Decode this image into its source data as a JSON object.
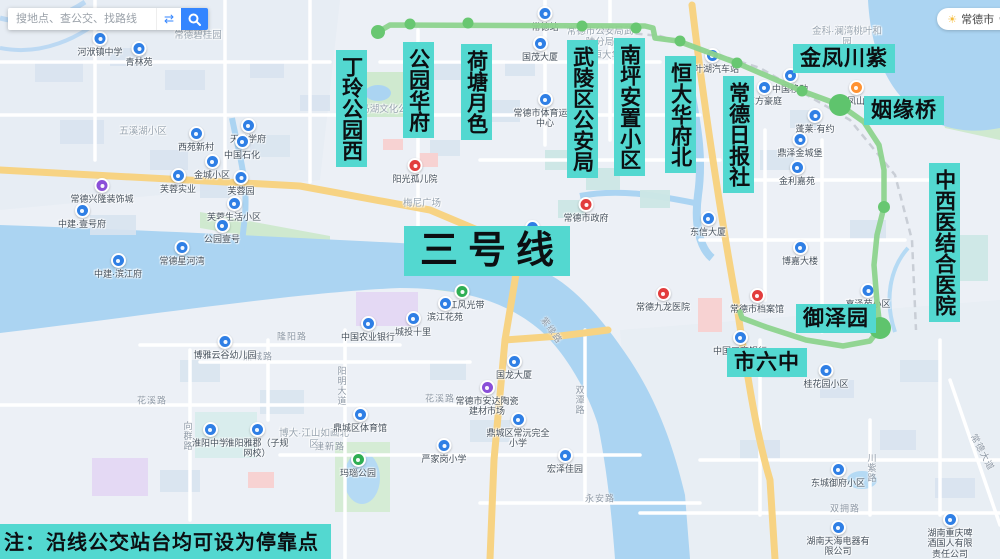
{
  "colors": {
    "label_bg": "#53d8d0",
    "route_line": "#8dd38d",
    "route_stop": "#68c771",
    "water": "#abd4f2",
    "accent_blue": "#3385ff"
  },
  "search": {
    "placeholder": "搜地点、查公交、找路线"
  },
  "city": {
    "name": "常德市",
    "caret": "∨",
    "weather_icon": "sun-icon"
  },
  "route": {
    "title": "三号线",
    "title_pos": {
      "x": 404,
      "y": 226
    },
    "note": "注：沿线公交站台均可设为停靠点",
    "polyline": [
      [
        378,
        32
      ],
      [
        390,
        25
      ],
      [
        645,
        26
      ],
      [
        653,
        28
      ],
      [
        655,
        38
      ],
      [
        678,
        41
      ],
      [
        737,
        63
      ],
      [
        802,
        91
      ],
      [
        840,
        105
      ],
      [
        864,
        122
      ],
      [
        879,
        145
      ],
      [
        884,
        170
      ],
      [
        884,
        207
      ],
      [
        877,
        235
      ],
      [
        874,
        265
      ],
      [
        877,
        302
      ],
      [
        880,
        328
      ],
      [
        870,
        341
      ],
      [
        843,
        346
      ],
      [
        806,
        340
      ],
      [
        766,
        327
      ],
      [
        742,
        318
      ],
      [
        740,
        312
      ]
    ],
    "stops": [
      {
        "x": 378,
        "y": 32,
        "r": 7
      },
      {
        "x": 410,
        "y": 24,
        "r": 5.5
      },
      {
        "x": 468,
        "y": 23,
        "r": 5.5
      },
      {
        "x": 582,
        "y": 26,
        "r": 5.5
      },
      {
        "x": 636,
        "y": 28,
        "r": 5.5
      },
      {
        "x": 680,
        "y": 41,
        "r": 5.5
      },
      {
        "x": 737,
        "y": 63,
        "r": 5.5
      },
      {
        "x": 802,
        "y": 91,
        "r": 5.5
      },
      {
        "x": 884,
        "y": 207,
        "r": 6
      },
      {
        "x": 840,
        "y": 105,
        "r": 11
      },
      {
        "x": 880,
        "y": 328,
        "r": 11
      }
    ],
    "stations": [
      {
        "text": "丁玲公园西",
        "x": 336,
        "y": 50,
        "v": true
      },
      {
        "text": "公园华府",
        "x": 403,
        "y": 42,
        "v": true
      },
      {
        "text": "荷塘月色",
        "x": 461,
        "y": 44,
        "v": true
      },
      {
        "text": "武陵区公安局",
        "x": 567,
        "y": 40,
        "v": true
      },
      {
        "text": "南坪安置小区",
        "x": 614,
        "y": 38,
        "v": true
      },
      {
        "text": "恒大华府北",
        "x": 665,
        "y": 56,
        "v": true
      },
      {
        "text": "常德日报社",
        "x": 723,
        "y": 76,
        "v": true
      },
      {
        "text": "金凤川紫",
        "x": 793,
        "y": 44,
        "v": false
      },
      {
        "text": "姻缘桥",
        "x": 864,
        "y": 96,
        "v": false
      },
      {
        "text": "中西医结合医院",
        "x": 929,
        "y": 163,
        "v": true
      },
      {
        "text": "御泽园",
        "x": 796,
        "y": 304,
        "v": false
      },
      {
        "text": "市六中",
        "x": 727,
        "y": 348,
        "v": false
      }
    ]
  },
  "map": {
    "pois": [
      {
        "t": "河洑镇中学",
        "x": 100,
        "y": 31,
        "c": "blue"
      },
      {
        "t": "青林苑",
        "x": 139,
        "y": 41,
        "c": "blue"
      },
      {
        "t": "常德碧桂园",
        "x": 198,
        "y": 30,
        "c": "area"
      },
      {
        "t": "五溪湖小区",
        "x": 143,
        "y": 126,
        "c": "area"
      },
      {
        "t": "西苑新村",
        "x": 196,
        "y": 126,
        "c": "blue"
      },
      {
        "t": "天健学府",
        "x": 248,
        "y": 118,
        "c": "blue"
      },
      {
        "t": "中国石化",
        "x": 242,
        "y": 134,
        "c": "blue"
      },
      {
        "t": "金城小区",
        "x": 212,
        "y": 154,
        "c": "blue"
      },
      {
        "t": "芙蓉实业",
        "x": 178,
        "y": 168,
        "c": "blue"
      },
      {
        "t": "芙蓉园",
        "x": 241,
        "y": 170,
        "c": "blue"
      },
      {
        "t": "常德兴隆装饰城",
        "x": 102,
        "y": 178,
        "c": "purple"
      },
      {
        "t": "中建·壹号府",
        "x": 82,
        "y": 203,
        "c": "blue"
      },
      {
        "t": "芙蓉生活小区",
        "x": 234,
        "y": 196,
        "c": "blue"
      },
      {
        "t": "公园壹号",
        "x": 222,
        "y": 218,
        "c": "blue"
      },
      {
        "t": "常德星河湾",
        "x": 182,
        "y": 240,
        "c": "blue"
      },
      {
        "t": "中建·滨江府",
        "x": 118,
        "y": 253,
        "c": "blue"
      },
      {
        "t": "白马湖文化公园",
        "x": 384,
        "y": 104,
        "c": "area"
      },
      {
        "t": "阳光孤儿院",
        "x": 415,
        "y": 158,
        "c": "red"
      },
      {
        "t": "梅尼广场",
        "x": 422,
        "y": 198,
        "c": "area"
      },
      {
        "t": "中国农业银行",
        "x": 368,
        "y": 316,
        "c": "blue"
      },
      {
        "t": "时代大厦",
        "x": 532,
        "y": 220,
        "c": "blue"
      },
      {
        "t": "常德站",
        "x": 545,
        "y": 6,
        "c": "blue"
      },
      {
        "t": "国茂大厦",
        "x": 540,
        "y": 36,
        "c": "blue"
      },
      {
        "t": "常德市公安局武陵分局",
        "x": 600,
        "y": 26,
        "c": "area"
      },
      {
        "t": "常德恒大华府",
        "x": 602,
        "y": 50,
        "c": "area"
      },
      {
        "t": "常德市体育运动中心",
        "x": 545,
        "y": 92,
        "c": "blue"
      },
      {
        "t": "常德市政府",
        "x": 586,
        "y": 197,
        "c": "red"
      },
      {
        "t": "桃叶湖汽车站",
        "x": 712,
        "y": 48,
        "c": "blue"
      },
      {
        "t": "金科·澜湾桃叶和园",
        "x": 847,
        "y": 26,
        "c": "area"
      },
      {
        "t": "中国移动",
        "x": 790,
        "y": 68,
        "c": "blue"
      },
      {
        "t": "东方豪庭",
        "x": 764,
        "y": 80,
        "c": "blue"
      },
      {
        "t": "龙凤山庄",
        "x": 856,
        "y": 80,
        "c": "orange"
      },
      {
        "t": "蓬莱·有约",
        "x": 815,
        "y": 108,
        "c": "blue"
      },
      {
        "t": "鼎泽金城堡",
        "x": 800,
        "y": 132,
        "c": "blue"
      },
      {
        "t": "金利嘉苑",
        "x": 797,
        "y": 160,
        "c": "blue"
      },
      {
        "t": "东信大厦",
        "x": 708,
        "y": 211,
        "c": "blue"
      },
      {
        "t": "博嘉大楼",
        "x": 800,
        "y": 240,
        "c": "blue"
      },
      {
        "t": "嘉泽苑小区",
        "x": 868,
        "y": 283,
        "c": "blue"
      },
      {
        "t": "常德九龙医院",
        "x": 663,
        "y": 286,
        "c": "red"
      },
      {
        "t": "常德市档案馆",
        "x": 757,
        "y": 288,
        "c": "red"
      },
      {
        "t": "中国工商银行",
        "x": 740,
        "y": 330,
        "c": "blue"
      },
      {
        "t": "桂花园小区",
        "x": 826,
        "y": 363,
        "c": "blue"
      },
      {
        "t": "沅江风光带",
        "x": 462,
        "y": 284,
        "c": "green"
      },
      {
        "t": "滨江花苑",
        "x": 445,
        "y": 296,
        "c": "blue"
      },
      {
        "t": "城投十里",
        "x": 413,
        "y": 311,
        "c": "blue"
      },
      {
        "t": "博雅云谷幼儿园",
        "x": 225,
        "y": 334,
        "c": "blue"
      },
      {
        "t": "淮阳中学",
        "x": 210,
        "y": 422,
        "c": "blue"
      },
      {
        "t": "淮阳雅郡（子规网校）",
        "x": 257,
        "y": 422,
        "c": "blue"
      },
      {
        "t": "博大·江山如画北区",
        "x": 314,
        "y": 428,
        "c": "area"
      },
      {
        "t": "鼎城区体育馆",
        "x": 360,
        "y": 407,
        "c": "blue"
      },
      {
        "t": "玛瑙公园",
        "x": 358,
        "y": 452,
        "c": "green"
      },
      {
        "t": "国龙大厦",
        "x": 514,
        "y": 354,
        "c": "blue"
      },
      {
        "t": "常德市安达陶瓷建材市场",
        "x": 487,
        "y": 380,
        "c": "purple"
      },
      {
        "t": "鼎城区常沅完全小学",
        "x": 518,
        "y": 412,
        "c": "blue"
      },
      {
        "t": "严家岗小学",
        "x": 444,
        "y": 438,
        "c": "blue"
      },
      {
        "t": "宏泽佳园",
        "x": 565,
        "y": 448,
        "c": "blue"
      },
      {
        "t": "东城御府小区",
        "x": 838,
        "y": 462,
        "c": "blue"
      },
      {
        "t": "湖南天海电器有限公司",
        "x": 838,
        "y": 520,
        "c": "blue"
      },
      {
        "t": "湖南重庆啤酒国人有限责任公司",
        "x": 950,
        "y": 512,
        "c": "blue"
      }
    ],
    "road_labels": [
      {
        "t": "双拥路",
        "x": 845,
        "y": 508
      },
      {
        "t": "常德大道",
        "x": 983,
        "y": 452,
        "r": 62
      },
      {
        "t": "川紫路",
        "x": 872,
        "y": 468,
        "v": true
      },
      {
        "t": "花溪路",
        "x": 152,
        "y": 400
      },
      {
        "t": "花溪路",
        "x": 440,
        "y": 398
      },
      {
        "t": "向群路",
        "x": 188,
        "y": 436,
        "v": true
      },
      {
        "t": "隆阳路",
        "x": 292,
        "y": 336
      },
      {
        "t": "鼎城路",
        "x": 258,
        "y": 356
      },
      {
        "t": "阳明大道",
        "x": 342,
        "y": 386,
        "v": true
      },
      {
        "t": "建新路",
        "x": 330,
        "y": 446
      },
      {
        "t": "永安路",
        "x": 600,
        "y": 498
      },
      {
        "t": "紫缘路",
        "x": 552,
        "y": 330,
        "r": 55
      },
      {
        "t": "双潭路",
        "x": 580,
        "y": 400,
        "v": true
      }
    ]
  }
}
